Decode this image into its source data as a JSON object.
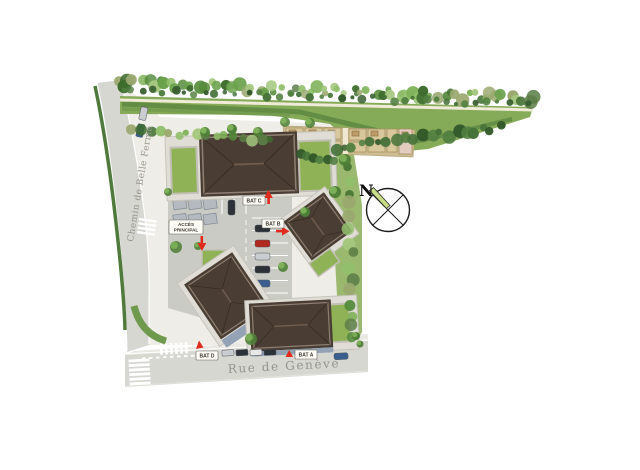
{
  "streets": {
    "left": "Chemin de Belle Ferme",
    "bottom": "Rue de Genève"
  },
  "compass": {
    "north_label": "N"
  },
  "labels": {
    "access": {
      "line1": "ACCÈS",
      "line2": "PRINCIPAL"
    },
    "bat_c": "BAT C",
    "bat_b": "BAT B",
    "bat_d": "BAT D",
    "bat_a": "BAT A"
  },
  "theme": {
    "road": "#d7d7d2",
    "sidewalk": "#e9e8e3",
    "plaza": "#efede7",
    "asphalt": "#cbcbc6",
    "verge": "#86ab58",
    "hedge": "#4f7a3c",
    "roofGarden": "#8fb257",
    "roof": "#4a3d33",
    "ridge": "#6e5c4e",
    "parapet": "#8d7f71",
    "podium": "#dfddd6",
    "facade": "#93a2b4",
    "path": "#f0ead9",
    "shedPlot": "#d9c89c",
    "shedOutline": "#a08a5c",
    "shedRoof": "#bf9b6a",
    "accentRed": "#e02b1d",
    "needle": "#c8dd85",
    "labelBg": "#fdfcf6",
    "labelBorder": "#6b675f",
    "streetText": "#95948c",
    "carDark": "#2c3237",
    "carRed": "#b1281e",
    "carBlue": "#3a5f8f",
    "carSilver": "#c9cdd0"
  }
}
